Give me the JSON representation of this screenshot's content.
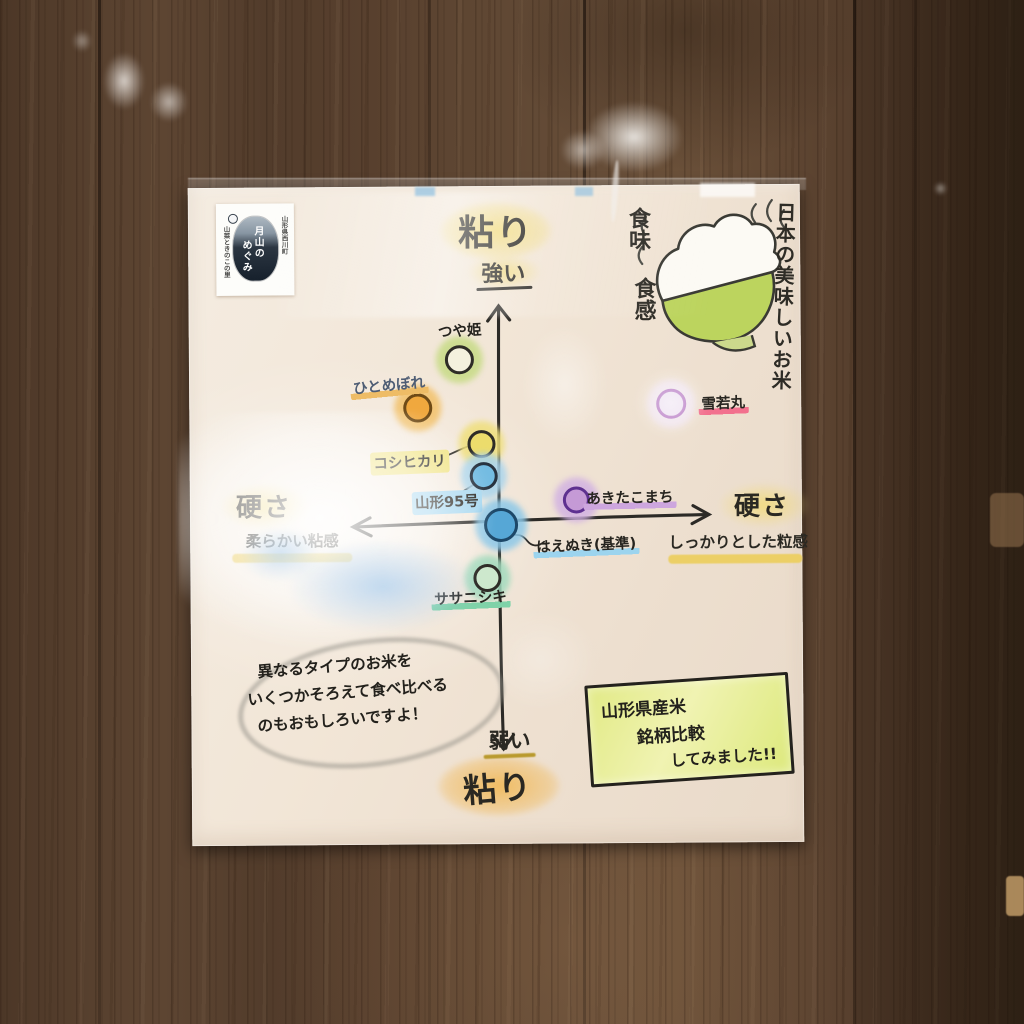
{
  "logo": {
    "main_col1": "月山の",
    "main_col2": "めぐみ",
    "right_side": "山形県西川町",
    "left_side": "山菜ときのこの里"
  },
  "bowl_illustration": {
    "caption_left_top": "食味",
    "caption_left_bottom": "食感",
    "caption_right": "日本の美味しいお米"
  },
  "note": {
    "line1": "異なるタイプのお米を",
    "line2": "いくつかそろえて食べ比べる",
    "line3": "のもおもしろいですよ！"
  },
  "title_box": {
    "line1": "山形県産米",
    "line2": "銘柄比較",
    "line3": "してみました!!"
  },
  "chart_data": {
    "type": "scatter",
    "title": "山形県産米 銘柄比較 してみました!!",
    "axis_y": {
      "name": "粘り",
      "top": "強い",
      "bottom": "弱い",
      "range": [
        -5,
        5
      ]
    },
    "axis_x": {
      "name": "硬さ",
      "left": "柔らかい粘感",
      "right": "しっかりとした粒感",
      "range": [
        -5,
        5
      ]
    },
    "baseline_point": "はえぬき(基準)",
    "origin_px": [
      310,
      337
    ],
    "points": [
      {
        "id": "tsuyahime",
        "name": "つや姫",
        "hardness": -1.0,
        "stickiness": 3.6,
        "px": [
          270,
          173
        ],
        "label_px": [
          271,
          145
        ],
        "size": 29,
        "fill": "#f4f1de",
        "ring": "#2e2c27",
        "halo": "#c7db86",
        "label_style": "none",
        "hl": null,
        "tilt": -3
      },
      {
        "id": "hitomebore",
        "name": "ひとめぼれ",
        "hardness": -2.0,
        "stickiness": 2.6,
        "px": [
          228,
          221
        ],
        "label_px": [
          200,
          199
        ],
        "size": 29,
        "fill": "#f0a83e",
        "ring": "#6e4a16",
        "halo": "#f2c16a",
        "label_style": "underline",
        "hl": "#eebc66",
        "label_color": "#4e5d74",
        "tilt": -5
      },
      {
        "id": "koshihikari",
        "name": "コシヒカリ",
        "hardness": -0.4,
        "stickiness": 1.8,
        "px": [
          292,
          258
        ],
        "label_px": [
          220,
          276
        ],
        "size": 28,
        "fill": "#ecdc6c",
        "ring": "#2e2c27",
        "halo": "#efdf7c",
        "label_style": "bg",
        "hl": "#f0e384",
        "tilt": -2
      },
      {
        "id": "yamagata-95",
        "name": "山形95号",
        "hardness": -0.4,
        "stickiness": 1.0,
        "px": [
          294,
          290
        ],
        "label_px": [
          257,
          316
        ],
        "size": 28,
        "fill": "#74bce2",
        "ring": "#283340",
        "halo": "#a8d4ec",
        "label_style": "bg",
        "hl": "#a8d8f0",
        "tilt": -2
      },
      {
        "id": "haenuki",
        "name": "はえぬき(基準)",
        "hardness": 0,
        "stickiness": 0,
        "px": [
          311,
          339
        ],
        "label_px": [
          396,
          360
        ],
        "size": 34,
        "fill": "#56a7d6",
        "ring": "#1d4868",
        "halo": "#8cc8e8",
        "label_style": "underline",
        "hl": "#9cd4ee",
        "tilt": -2
      },
      {
        "id": "akitakomachi",
        "name": "あきたこまち",
        "hardness": 1.8,
        "stickiness": 0.5,
        "px": [
          386,
          314
        ],
        "label_px": [
          440,
          313
        ],
        "size": 27,
        "fill": "#c59ad6",
        "ring": "#5e3190",
        "halo": "#d2b2e2",
        "label_style": "underline",
        "hl": "#cda6de",
        "tilt": -1
      },
      {
        "id": "yukiwakamaru",
        "name": "雪若丸",
        "hardness": 4.1,
        "stickiness": 2.6,
        "px": [
          482,
          219
        ],
        "label_px": [
          534,
          219
        ],
        "size": 30,
        "fill": "#ecdff0",
        "ring": "#b272c0",
        "halo": "#f0e4f0",
        "label_style": "underline",
        "hl": "#f2718e",
        "tilt": -2
      },
      {
        "id": "sasanishiki",
        "name": "ササニシキ",
        "hardness": -0.3,
        "stickiness": -1.2,
        "px": [
          297,
          392
        ],
        "label_px": [
          280,
          412
        ],
        "size": 28,
        "fill": "#cde8cd",
        "ring": "#2e2c27",
        "halo": "#a2dabd",
        "label_style": "underline",
        "hl": "#7fd2a8",
        "tilt": -2
      }
    ]
  }
}
